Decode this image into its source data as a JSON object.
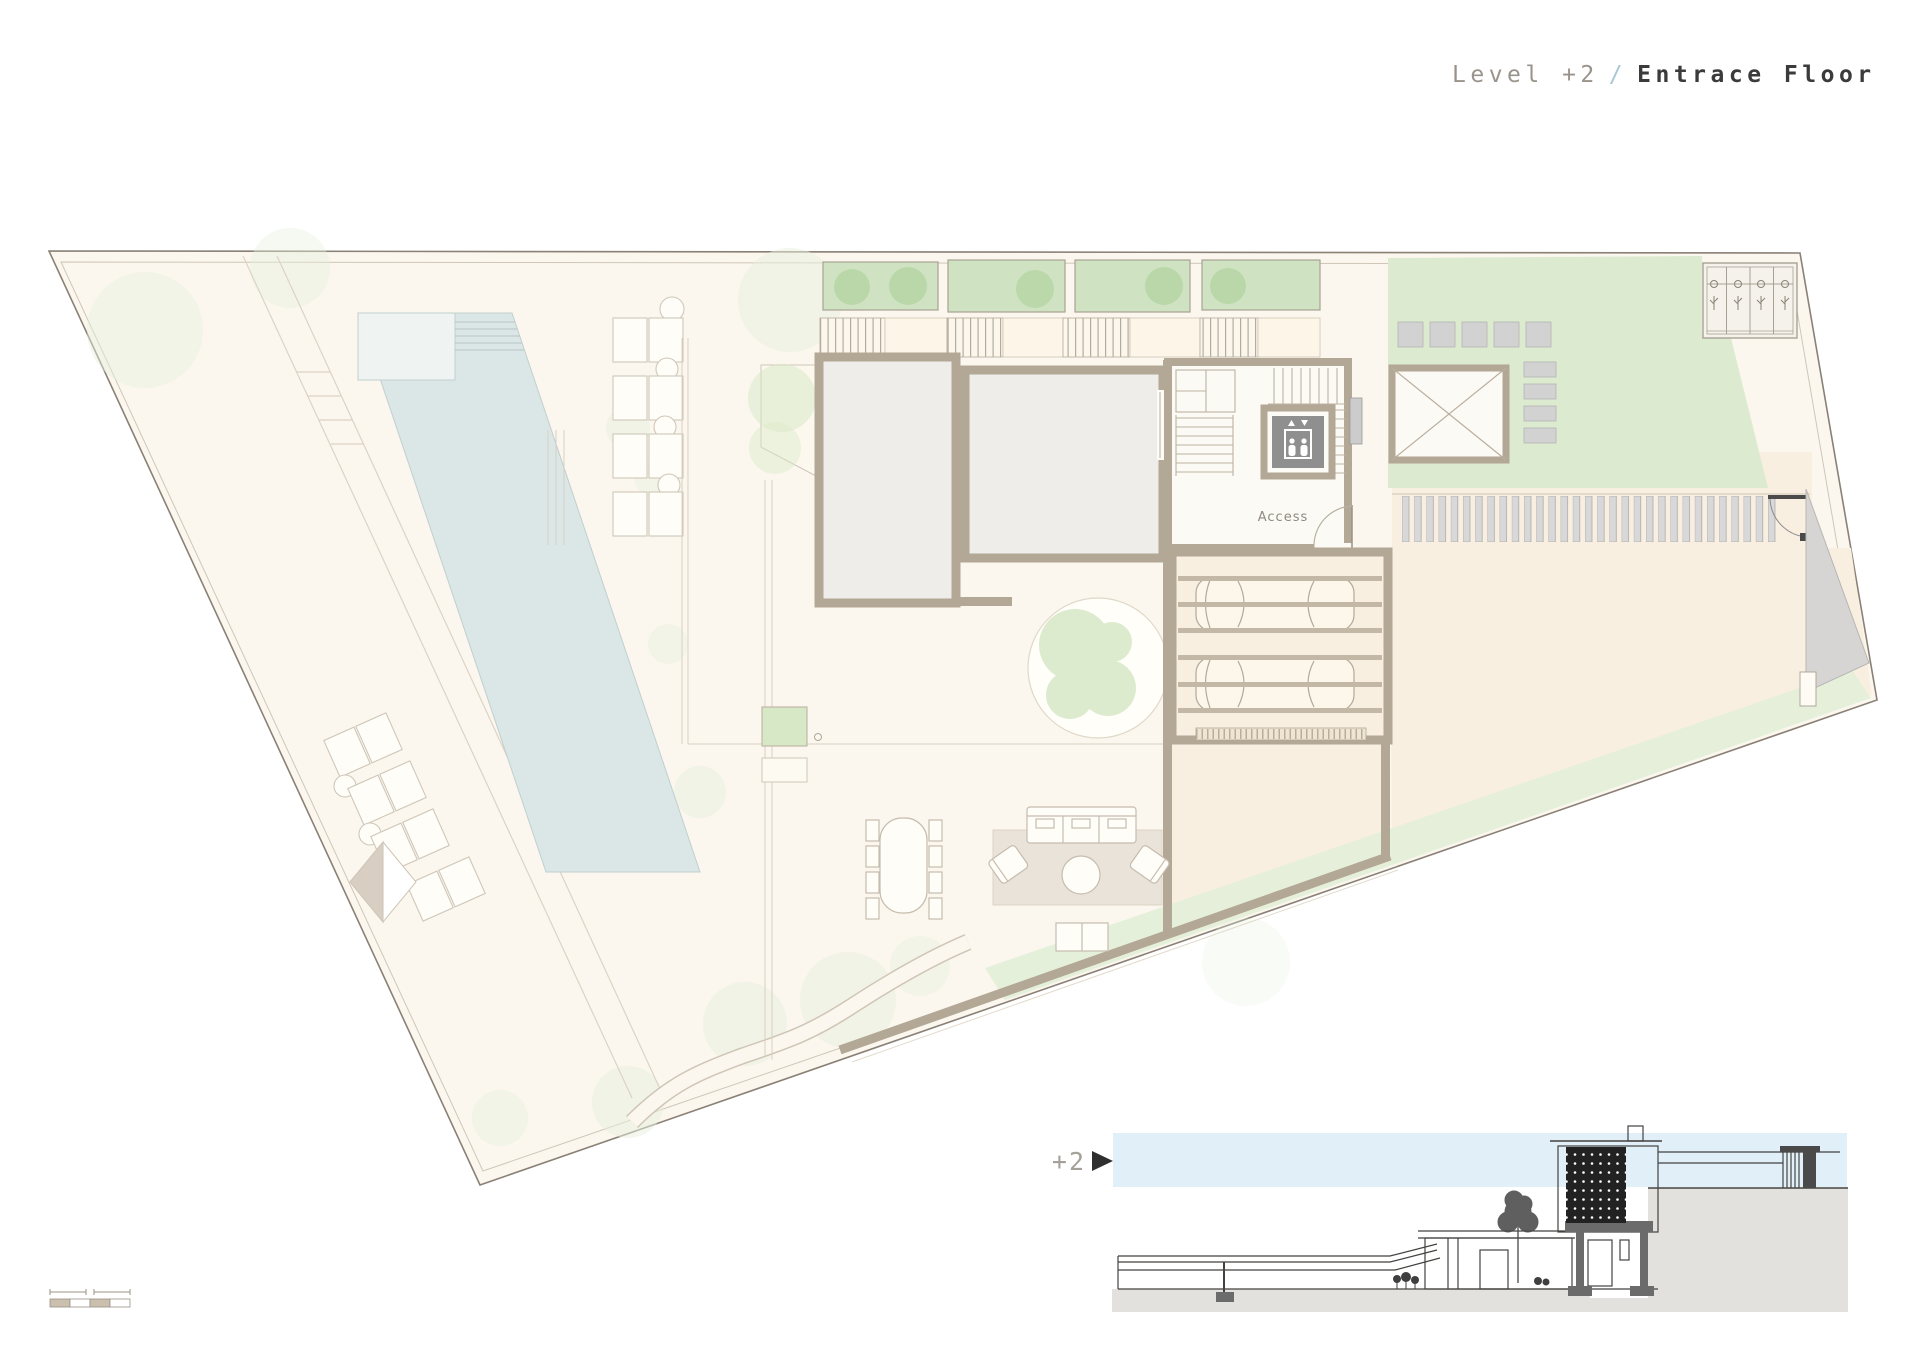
{
  "header": {
    "title_level": "Level +2",
    "title_separator": "/",
    "title_name": "Entrace Floor"
  },
  "plan": {
    "access_label": "Access"
  },
  "section": {
    "marker_label": "+2"
  },
  "scale_bar": {
    "segments": 4
  },
  "icons": {
    "elevator": "elevator-people-icon",
    "level_marker": "right-arrow-icon"
  },
  "palette": {
    "site_fill": "#fbf7ee",
    "site_border": "#8a8076",
    "peach": "#f9efe1",
    "wall_tan": "#b3a795",
    "room_gray": "#efedea",
    "pool_blue": "#dbe7e6",
    "planter_green": "#cfe3c2",
    "shrub_green": "#b7d6a6",
    "lawn_green": "#dcead0",
    "band_green": "#e2eed8",
    "paver_gray": "#d6d5d3",
    "stripe_gray": "#d8d8d8",
    "elevator_gray": "#8f8f8f",
    "sky_blue": "#e1eff9",
    "ground_gray": "#e3e1dd",
    "section_line": "#44423f",
    "poche_gray": "#6b6b6b",
    "title_gray": "#9a938b",
    "title_dark": "#3b3b3b",
    "slash_blue": "#a9c7d6",
    "label_gray": "#8f8a82",
    "scalebar_tan": "#cbbfae"
  }
}
